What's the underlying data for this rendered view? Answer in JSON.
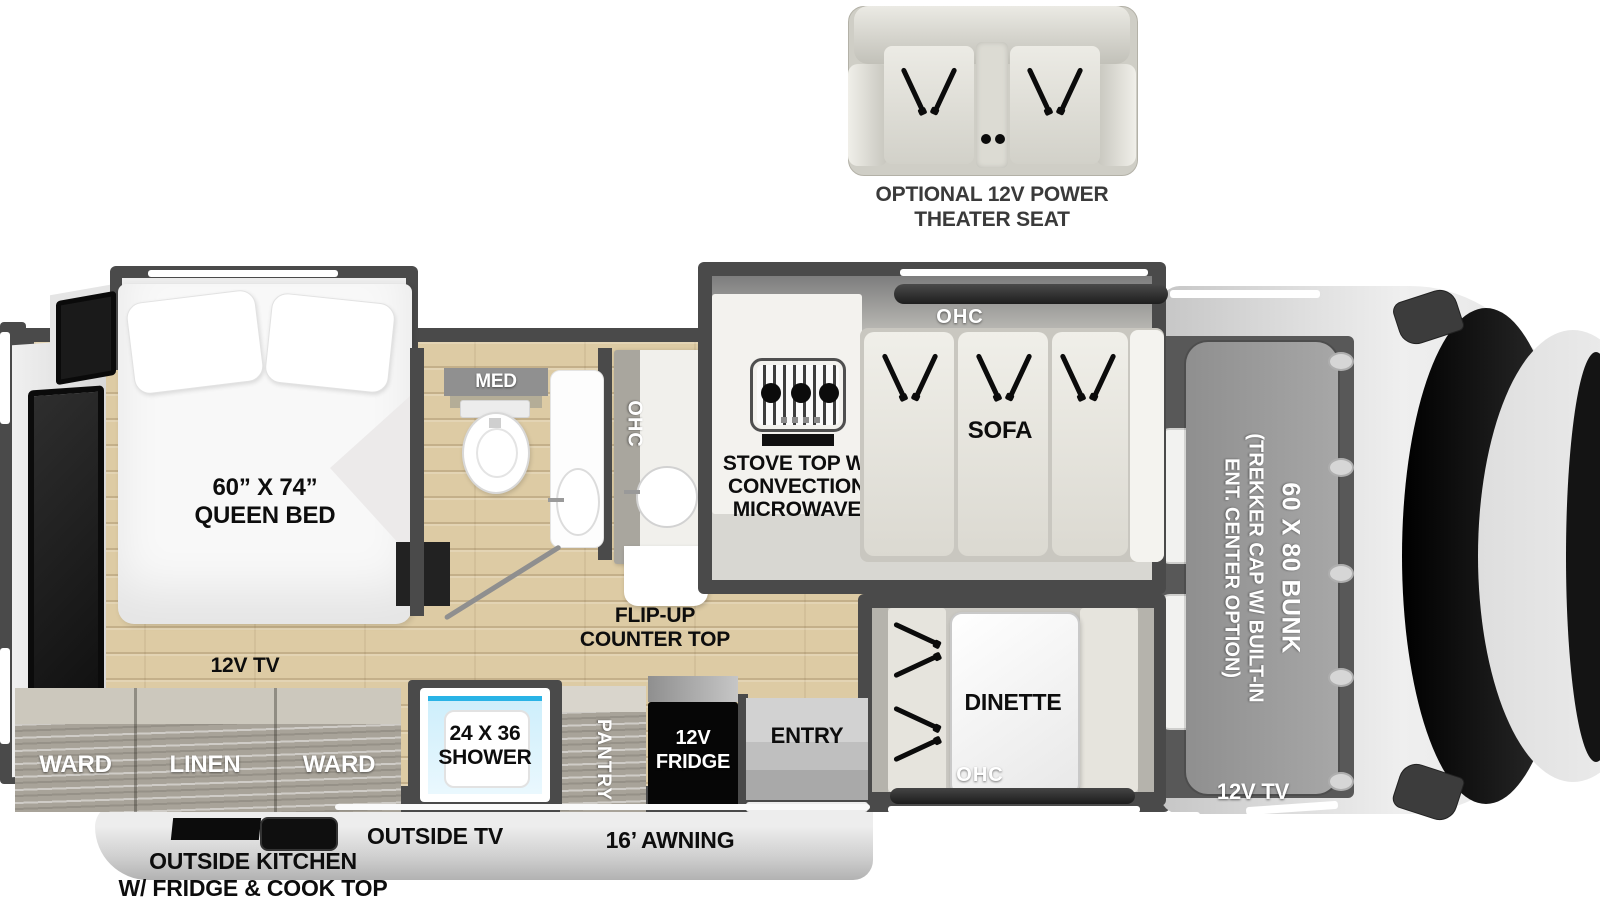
{
  "colors": {
    "wall": "#4a4a4a",
    "floor": "#ddcba4",
    "cabinet_wood": "#a8a399",
    "body_silver": "#d9d9d9",
    "bunk_gray": "#9a9a9a",
    "shower_blue": "#29b3e6",
    "label_dark": "#101010",
    "label_light": "#ffffff"
  },
  "optional_seat": {
    "line1": "OPTIONAL 12V POWER",
    "line2": "THEATER SEAT"
  },
  "bedroom": {
    "bed_size": "60” X 74”",
    "bed_type": "QUEEN BED",
    "tv": "12V TV",
    "ward_left": "WARD",
    "linen": "LINEN",
    "ward_right": "WARD"
  },
  "bathroom": {
    "med": "MED"
  },
  "kitchen": {
    "ohc": "OHC",
    "flip_up_1": "FLIP-UP",
    "flip_up_2": "COUNTER TOP",
    "stove_1": "STOVE TOP W/",
    "stove_2": "CONVECTION",
    "stove_3": "MICROWAVE"
  },
  "living": {
    "sofa_ohc": "OHC",
    "sofa": "SOFA",
    "dinette": "DINETTE",
    "dinette_ohc": "OHC"
  },
  "utility": {
    "shower_1": "24 X 36",
    "shower_2": "SHOWER",
    "pantry": "PANTRY",
    "fridge_1": "12V",
    "fridge_2": "FRIDGE",
    "entry": "ENTRY"
  },
  "cab": {
    "bunk_size": "60 X 80 BUNK",
    "cap_1": "(TREKKER CAP W/ BUILT-IN",
    "cap_2": "ENT. CENTER OPTION)",
    "tv": "12V TV"
  },
  "exterior": {
    "outside_tv": "OUTSIDE TV",
    "outside_kitchen_1": "OUTSIDE KITCHEN",
    "outside_kitchen_2": "W/ FRIDGE & COOK TOP",
    "awning": "16’ AWNING"
  }
}
